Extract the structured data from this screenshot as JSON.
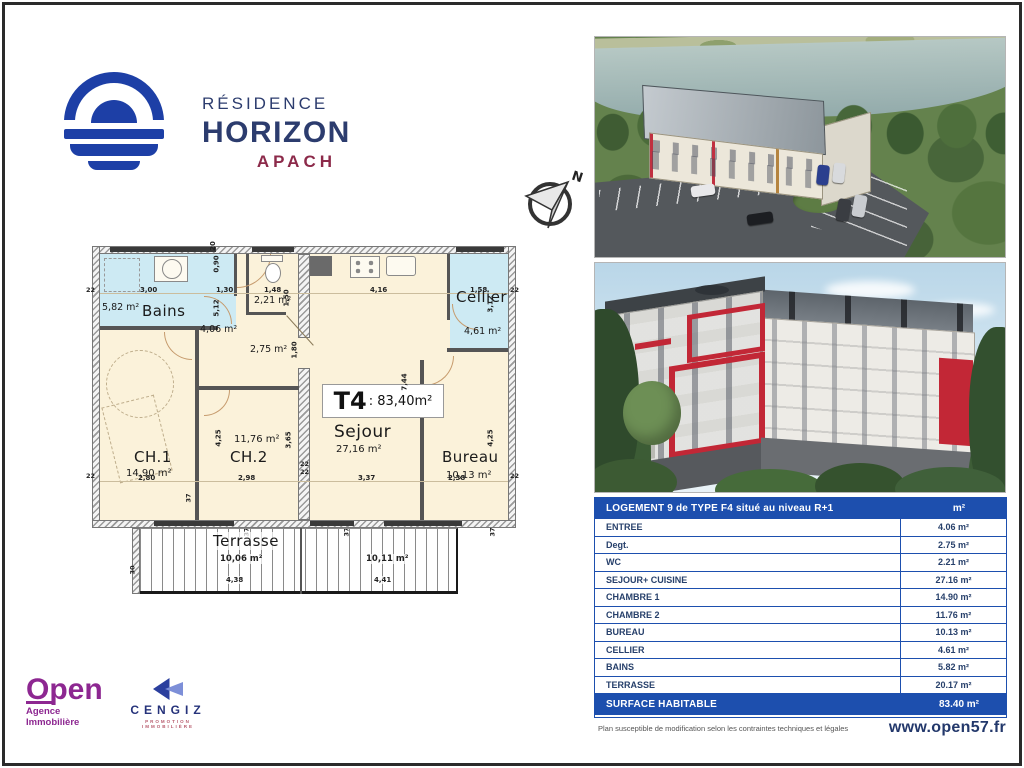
{
  "logo": {
    "residence": "RÉSIDENCE",
    "horizon": "HORIZON",
    "apach": "APACH"
  },
  "compass": {
    "north": "N"
  },
  "plan": {
    "t4": "T4",
    "t4_area": ": 83,40m²",
    "bains": "Bains",
    "bains_area": "5,82 m²",
    "cellier": "Cellier",
    "cellier_area": "4,61 m²",
    "ch1": "CH.1",
    "ch1_area": "14,90 m²",
    "ch2": "CH.2",
    "ch2_area": "11,76 m²",
    "sejour": "Sejour",
    "sejour_area": "27,16 m²",
    "bureau": "Bureau",
    "bureau_area": "10,13 m²",
    "terrasse": "Terrasse",
    "terrasse_area1": "10,06 m²",
    "terrasse_area2": "10,11 m²",
    "entree_area": "4,06 m²",
    "wc_area": "2,21 m²",
    "degt_area": "2,75 m²",
    "dims": {
      "t1": "3,00",
      "t2": "1,30",
      "t3": "1,48",
      "t4d": "4,16",
      "t5": "1,58",
      "b1": "2,80",
      "b2": "2,98",
      "b3": "3,37",
      "b4": "2,38",
      "v1": "5,12",
      "v2": "1,50",
      "v3": "1,80",
      "v4": "3,12",
      "v5": "7,44",
      "v6": "3,65",
      "v7": "4,25",
      "v8": "4,25",
      "v9": "0,90",
      "v10": "20",
      "ter1": "4,38",
      "ter2": "4,41",
      "ter3": "30",
      "w22": "22",
      "w37": "37"
    }
  },
  "table": {
    "title": "LOGEMENT 9 de TYPE F4 situé au niveau R+1",
    "unit": "m²",
    "rows": [
      {
        "label": "ENTREE",
        "value": "4.06 m²"
      },
      {
        "label": "Degt.",
        "value": "2.75 m²"
      },
      {
        "label": "WC",
        "value": "2.21 m²"
      },
      {
        "label": "SEJOUR+ CUISINE",
        "value": "27.16 m²"
      },
      {
        "label": "CHAMBRE 1",
        "value": "14.90 m²"
      },
      {
        "label": "CHAMBRE 2",
        "value": "11.76 m²"
      },
      {
        "label": "BUREAU",
        "value": "10.13 m²"
      },
      {
        "label": "CELLIER",
        "value": "4.61 m²"
      },
      {
        "label": "BAINS",
        "value": "5.82 m²"
      },
      {
        "label": "TERRASSE",
        "value": "20.17 m²"
      }
    ],
    "total_label": "SURFACE HABITABLE",
    "total_value": "83.40 m²"
  },
  "footer": {
    "note": "Plan susceptible de modification selon les contraintes techniques et légales",
    "website": "www.open57.fr"
  },
  "branding": {
    "open": "Open",
    "open_sub": "Agence Immobilière",
    "cengiz": "CENGIZ",
    "cengiz_sub": "PROMOTION IMMOBILIÈRE"
  },
  "colors": {
    "table_blue": "#1d4fae",
    "logo_blue": "#1d3fa6",
    "navy": "#2c3c6e",
    "maroon": "#8c2a4a",
    "purple": "#8d2791",
    "plan_beige": "#fbf2da",
    "plan_room_blue": "#cdeaf3",
    "accent_red": "#c22736"
  }
}
